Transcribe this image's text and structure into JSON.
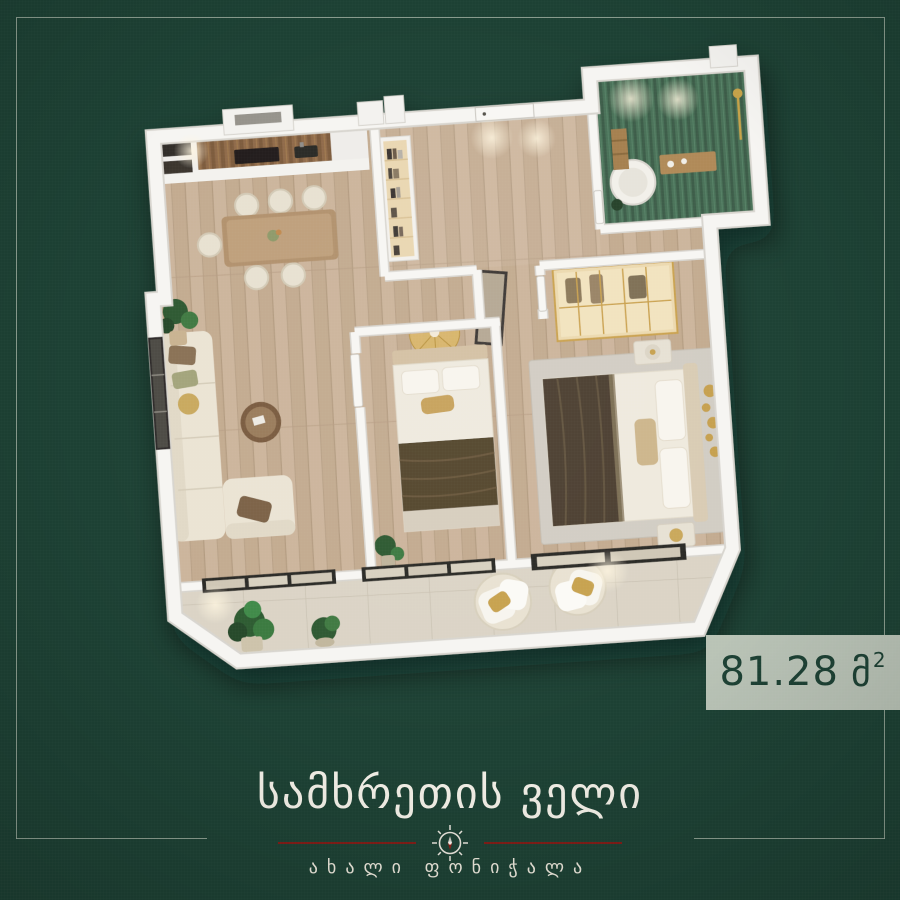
{
  "poster": {
    "background_color": "#1d4134",
    "frame_color": "#a4b2a4"
  },
  "area_badge": {
    "value": "81.28",
    "unit": "მ",
    "superscript": "2",
    "background_color": "#b9c3b6",
    "text_color": "#1d4134"
  },
  "brand": {
    "title": "სამხრეთის ველი",
    "subtitle": "ახალი ფონიჭალა",
    "divider_color": "#801d17",
    "compass_icon": "compass-icon"
  },
  "floorplan": {
    "colors": {
      "wall": "#f6f5f2",
      "wood_floor": "#ccb59c",
      "balcony_tile": "#dbd4c6",
      "bathroom_tile": "#4a7158",
      "accent_gold": "#c7a24f",
      "window_frame": "#2c2a27",
      "sofa_cream": "#ece5d6",
      "blanket_brown": "#54452f"
    }
  }
}
